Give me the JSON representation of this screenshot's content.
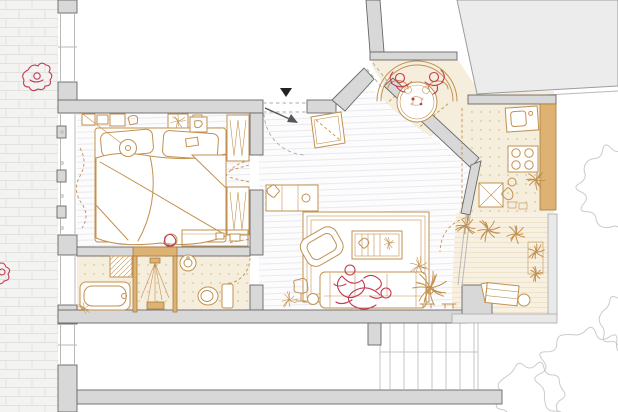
{
  "meta": {
    "title": "Hand-drawn apartment floor plan with courtyard, patio nook, outdoor kitchen and terrace",
    "canvas_width": 618,
    "canvas_height": 412
  },
  "palette": {
    "wall_fill": "#d8d8d8",
    "wall_edge": "#686868",
    "mass_fill": "#ececec",
    "mass_edge": "#9c9c9c",
    "tan": "#c2914f",
    "tan_dark": "#a87b3a",
    "tan_fill": "#ddb273",
    "beige": "#f6eedd",
    "beige_light": "#f8f1e2",
    "plank_line": "#e9e9f1",
    "dot": "#dcc193",
    "terr_line": "#ecdfc4",
    "red_figure": "#c23a50",
    "brick_bg": "#f3f3f2",
    "brick_line": "#e2e1df",
    "tree_line": "#cbcbcb",
    "stair_line": "#c6c6c6",
    "ink": "#222222",
    "door_gray": "#555555"
  },
  "scene": {
    "rooms": [
      {
        "id": "bedroom",
        "items": [
          "double-bed",
          "pillows",
          "duvet",
          "pendant-lamp",
          "wardrobe",
          "nightstand",
          "shelf-clutter",
          "curtain",
          "vanity-desk",
          "vanity-stool"
        ]
      },
      {
        "id": "bathroom",
        "items": [
          "bathtub",
          "walk-in-shower",
          "washing-machine",
          "washbasin",
          "toilet"
        ]
      },
      {
        "id": "living-room",
        "items": [
          "sofa",
          "rug",
          "armchair",
          "coffee-table",
          "floor-lamp",
          "side-table",
          "sideboard",
          "houseplants",
          "bench"
        ]
      },
      {
        "id": "entry-hall",
        "items": [
          "entrance-marker",
          "door-swing-arrow",
          "built-in-cabinet"
        ]
      },
      {
        "id": "patio-nook",
        "items": [
          "round-dining-table",
          "curved-bench",
          "flower-centerpiece",
          "two-diners"
        ]
      },
      {
        "id": "outdoor-kitchen",
        "items": [
          "counter",
          "sink",
          "stove",
          "cafe-table",
          "potted-plants"
        ]
      },
      {
        "id": "terrace",
        "items": [
          "lounge-chair",
          "planters",
          "side-table"
        ]
      },
      {
        "id": "exterior",
        "items": [
          "brick-sidewalk",
          "pedestrians",
          "trees",
          "staircase",
          "neighboring-buildings"
        ]
      }
    ],
    "figures": [
      {
        "location": "sidewalk",
        "count": 1
      },
      {
        "location": "street-edge",
        "count": 1
      },
      {
        "location": "patio-table",
        "count": 2
      },
      {
        "location": "sofa",
        "count": 2
      },
      {
        "location": "vanity-stool",
        "count": 1
      }
    ]
  }
}
